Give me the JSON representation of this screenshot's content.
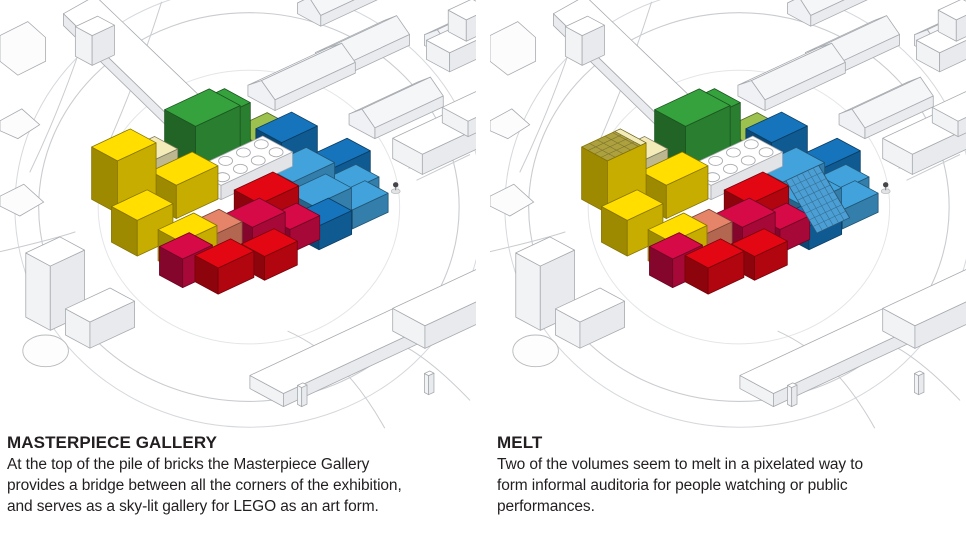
{
  "figure": {
    "panels": [
      {
        "id": "masterpiece-gallery",
        "variant": "base",
        "title": "MASTERPIECE GALLERY",
        "caption": "At the top of the pile of bricks the Masterpiece Gallery\nprovides a bridge between all the corners of the exhibition,\nand serves as a sky-lit gallery for LEGO as an art form."
      },
      {
        "id": "melt",
        "variant": "melt",
        "title": "MELT",
        "caption": "Two of the volumes seem to melt in a pixelated way to\nform informal auditoria for people watching or public\nperformances."
      }
    ],
    "palette": {
      "yellow": "#FFDE00",
      "paleYellow": "#F3ECB8",
      "green": "#35A23E",
      "lightGreen": "#9CC14F",
      "blueDark": "#1574BB",
      "blueLight": "#42A2DB",
      "red": "#E30613",
      "crimson": "#D50A47",
      "salmon": "#E58468",
      "white": "#FFFFFF",
      "oliveMelt": "#ACA03F",
      "blueMelt": "#4C9FD4",
      "outline": "#A6AAAF",
      "road": "#C9CCD0",
      "text": "#231F20"
    }
  }
}
